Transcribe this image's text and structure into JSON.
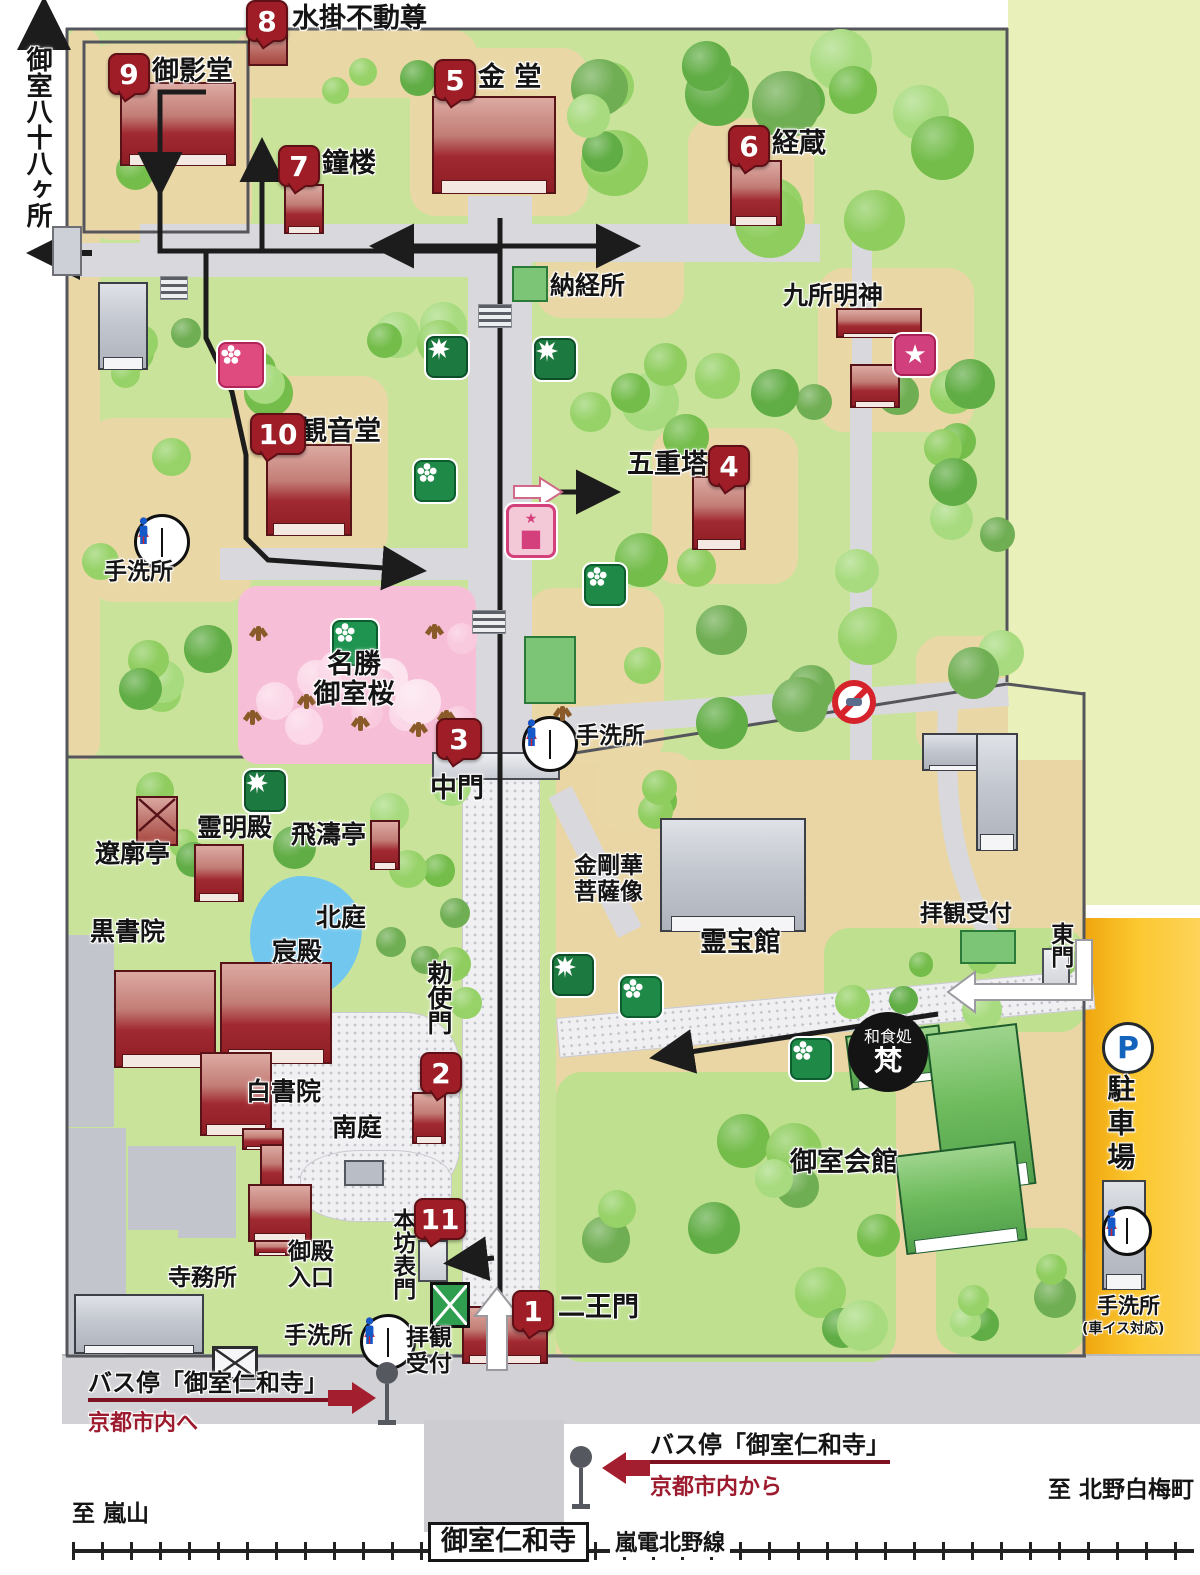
{
  "colors": {
    "badge_red": "#9e1d26",
    "route_black": "#1c1c1c",
    "bus_red": "#a31f2f",
    "parking_orange": "#f7b41c",
    "pond_blue": "#72c7ee",
    "sakura_pink": "#f6bfd7"
  },
  "numbered_sites": [
    {
      "num": "1",
      "name": "二王門"
    },
    {
      "num": "2",
      "name": "勅使門"
    },
    {
      "num": "3",
      "name": "中門"
    },
    {
      "num": "4",
      "name": "五重塔"
    },
    {
      "num": "5",
      "name": "金 堂"
    },
    {
      "num": "6",
      "name": "経蔵"
    },
    {
      "num": "7",
      "name": "鐘楼"
    },
    {
      "num": "8",
      "name": "水掛不動尊"
    },
    {
      "num": "9",
      "name": "御影堂"
    },
    {
      "num": "10",
      "name": "観音堂"
    },
    {
      "num": "11",
      "name": "本坊表門"
    }
  ],
  "badges": [
    {
      "n": "8",
      "x": 246,
      "y": 0,
      "w": 38
    },
    {
      "n": "9",
      "x": 108,
      "y": 53,
      "w": 38
    },
    {
      "n": "7",
      "x": 278,
      "y": 145,
      "w": 38
    },
    {
      "n": "5",
      "x": 434,
      "y": 59,
      "w": 38
    },
    {
      "n": "6",
      "x": 728,
      "y": 125,
      "w": 38
    },
    {
      "n": "4",
      "x": 708,
      "y": 445,
      "w": 38
    },
    {
      "n": "10",
      "x": 250,
      "y": 413,
      "w": 52
    },
    {
      "n": "3",
      "x": 436,
      "y": 718,
      "w": 42
    },
    {
      "n": "2",
      "x": 420,
      "y": 1052,
      "w": 38
    },
    {
      "n": "11",
      "x": 414,
      "y": 1198,
      "w": 48
    },
    {
      "n": "1",
      "x": 512,
      "y": 1290,
      "w": 38
    }
  ],
  "labels": [
    {
      "t": "御室八十八ヶ所",
      "x": 22,
      "y": 46,
      "s": 26,
      "v": 1,
      "n": "omuro-88-label"
    },
    {
      "t": "水掛不動尊",
      "x": 292,
      "y": 4,
      "s": 27
    },
    {
      "t": "御影堂",
      "x": 152,
      "y": 57,
      "s": 27
    },
    {
      "t": "鐘楼",
      "x": 322,
      "y": 149,
      "s": 27
    },
    {
      "t": "金 堂",
      "x": 478,
      "y": 63,
      "s": 27
    },
    {
      "t": "経蔵",
      "x": 772,
      "y": 129,
      "s": 27
    },
    {
      "t": "納経所",
      "x": 550,
      "y": 272,
      "s": 25
    },
    {
      "t": "九所明神",
      "x": 783,
      "y": 282,
      "s": 25
    },
    {
      "t": "観音堂",
      "x": 300,
      "y": 417,
      "s": 27
    },
    {
      "t": "手洗所",
      "x": 104,
      "y": 560,
      "s": 23
    },
    {
      "t": "五重塔",
      "x": 627,
      "y": 450,
      "s": 27
    },
    {
      "t": "名勝\n御室桜",
      "x": 296,
      "y": 650,
      "s": 27,
      "c": 1,
      "w": 116
    },
    {
      "t": "中門",
      "x": 430,
      "y": 774,
      "s": 27
    },
    {
      "t": "手洗所",
      "x": 576,
      "y": 724,
      "s": 23
    },
    {
      "t": "霊明殿",
      "x": 197,
      "y": 814,
      "s": 25
    },
    {
      "t": "飛濤亭",
      "x": 291,
      "y": 821,
      "s": 25
    },
    {
      "t": "遼廓亭",
      "x": 95,
      "y": 840,
      "s": 25
    },
    {
      "t": "北庭",
      "x": 316,
      "y": 904,
      "s": 25
    },
    {
      "t": "黒書院",
      "x": 90,
      "y": 918,
      "s": 25
    },
    {
      "t": "宸殿",
      "x": 272,
      "y": 938,
      "s": 25
    },
    {
      "t": "白書院",
      "x": 246,
      "y": 1078,
      "s": 25
    },
    {
      "t": "南庭",
      "x": 332,
      "y": 1114,
      "s": 25
    },
    {
      "t": "勅使門",
      "x": 424,
      "y": 960,
      "s": 25,
      "v": 1
    },
    {
      "t": "本坊表門",
      "x": 388,
      "y": 1208,
      "s": 23,
      "v": 1
    },
    {
      "t": "御殿\n入口",
      "x": 288,
      "y": 1240,
      "s": 23
    },
    {
      "t": "寺務所",
      "x": 168,
      "y": 1266,
      "s": 23
    },
    {
      "t": "手洗所",
      "x": 284,
      "y": 1324,
      "s": 23
    },
    {
      "t": "拝観\n受付",
      "x": 406,
      "y": 1326,
      "s": 23
    },
    {
      "t": "二王門",
      "x": 558,
      "y": 1293,
      "s": 27
    },
    {
      "t": "金剛華\n菩薩像",
      "x": 574,
      "y": 854,
      "s": 23
    },
    {
      "t": "霊宝館",
      "x": 700,
      "y": 928,
      "s": 27
    },
    {
      "t": "拝観受付",
      "x": 920,
      "y": 902,
      "s": 23
    },
    {
      "t": "東門",
      "x": 1046,
      "y": 922,
      "s": 23,
      "v": 1
    },
    {
      "t": "駐車場",
      "x": 1104,
      "y": 1074,
      "s": 28,
      "v": 1,
      "ls": 6
    },
    {
      "t": "御室会館",
      "x": 790,
      "y": 1148,
      "s": 27
    },
    {
      "t": "手洗所",
      "x": 1097,
      "y": 1295,
      "s": 21
    },
    {
      "t": "(車イス対応)",
      "x": 1082,
      "y": 1322,
      "s": 14
    },
    {
      "t": "バス停「御室仁和寺」",
      "x": 88,
      "y": 1370,
      "s": 24,
      "u": 1,
      "n": "bus-stop-west-label"
    },
    {
      "t": "京都市内へ",
      "x": 88,
      "y": 1412,
      "s": 22,
      "red": 1
    },
    {
      "t": "バス停「御室仁和寺」",
      "x": 650,
      "y": 1432,
      "s": 24,
      "u": 1,
      "n": "bus-stop-east-label"
    },
    {
      "t": "京都市内から",
      "x": 650,
      "y": 1476,
      "s": 22,
      "red": 1
    },
    {
      "t": "至 嵐山",
      "x": 72,
      "y": 1502,
      "s": 23
    },
    {
      "t": "至 北野白梅町",
      "x": 1048,
      "y": 1478,
      "s": 23
    },
    {
      "t": "嵐電北野線",
      "x": 610,
      "y": 1532,
      "s": 22,
      "wbg": 1
    },
    {
      "t": "御室仁和寺",
      "x": 428,
      "y": 1522,
      "s": 27,
      "box": 1,
      "n": "station-label"
    }
  ],
  "washoku": {
    "line1": "和食処",
    "line2": "梵"
  },
  "icons": {
    "toilets": [
      {
        "x": 134,
        "y": 514,
        "d": 50
      },
      {
        "x": 522,
        "y": 716,
        "d": 50
      },
      {
        "x": 360,
        "y": 1314,
        "d": 50
      },
      {
        "x": 1102,
        "y": 1206,
        "d": 44
      }
    ],
    "pink_flower": [
      {
        "x": 218,
        "y": 342
      }
    ],
    "pink_star": [
      {
        "x": 894,
        "y": 334
      }
    ],
    "pink_shrine": [
      {
        "x": 506,
        "y": 504
      }
    ],
    "green_sakura": [
      {
        "x": 332,
        "y": 620
      }
    ],
    "green_maple": [
      {
        "x": 426,
        "y": 336
      },
      {
        "x": 534,
        "y": 338
      },
      {
        "x": 244,
        "y": 770
      },
      {
        "x": 552,
        "y": 954
      }
    ],
    "green_flower": [
      {
        "x": 414,
        "y": 460
      },
      {
        "x": 584,
        "y": 564
      },
      {
        "x": 620,
        "y": 976
      },
      {
        "x": 790,
        "y": 1038
      }
    ],
    "no_entry": [
      {
        "x": 832,
        "y": 680
      }
    ],
    "parking_p": [
      {
        "x": 1102,
        "y": 1022
      }
    ],
    "green_square": [
      {
        "x": 512,
        "y": 266,
        "w": 32,
        "h": 32
      },
      {
        "x": 960,
        "y": 930,
        "w": 52,
        "h": 30
      },
      {
        "x": 524,
        "y": 636,
        "w": 48,
        "h": 64
      }
    ],
    "green_diamond": [
      {
        "x": 430,
        "y": 1282
      }
    ],
    "gray_box": [
      {
        "x": 52,
        "y": 226
      }
    ],
    "gate_box": [
      {
        "x": 212,
        "y": 1346
      }
    ],
    "bench": [
      {
        "x": 344,
        "y": 1160
      }
    ],
    "stairs": [
      {
        "x": 160,
        "y": 276,
        "w": 26
      },
      {
        "x": 478,
        "y": 304,
        "w": 32
      },
      {
        "x": 472,
        "y": 610,
        "w": 32
      }
    ],
    "bus_stops": [
      {
        "x": 374,
        "y": 1362
      },
      {
        "x": 568,
        "y": 1446
      }
    ],
    "trunks": [
      {
        "x": 256,
        "y": 626
      },
      {
        "x": 250,
        "y": 710
      },
      {
        "x": 304,
        "y": 694
      },
      {
        "x": 358,
        "y": 716
      },
      {
        "x": 432,
        "y": 624
      },
      {
        "x": 444,
        "y": 710
      },
      {
        "x": 416,
        "y": 722
      },
      {
        "x": 560,
        "y": 706
      }
    ]
  }
}
